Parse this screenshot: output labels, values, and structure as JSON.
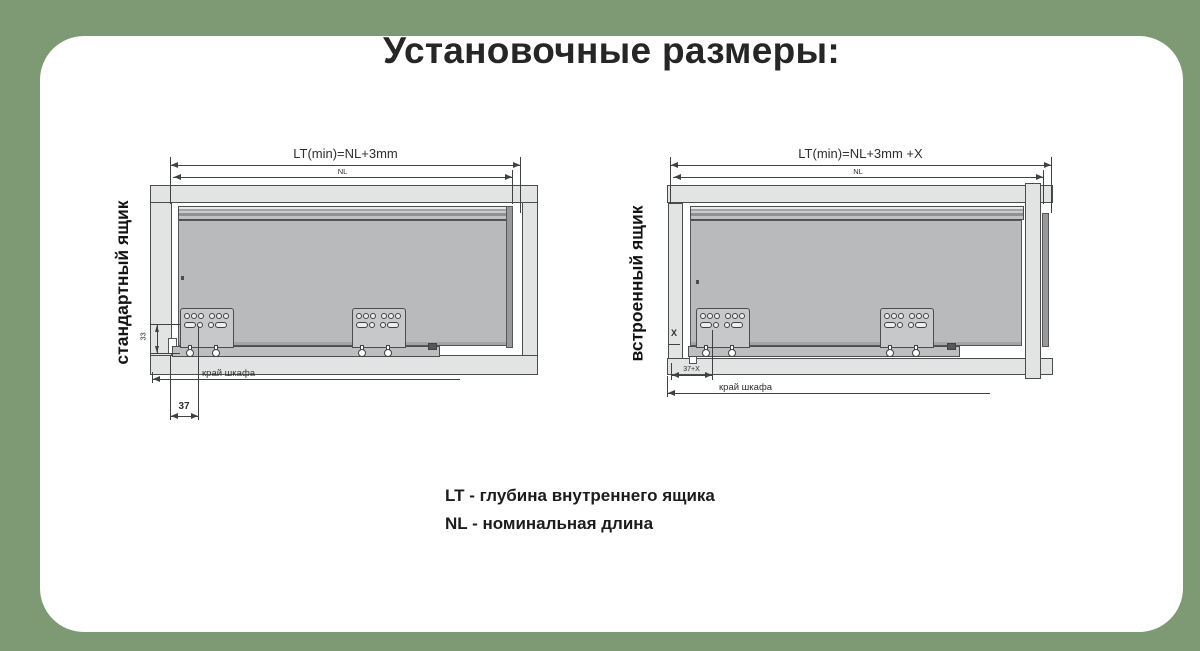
{
  "title": "Установочные размеры:",
  "colors": {
    "background": "#7d9a74",
    "card": "#ffffff",
    "drawing_line": "#3f4142",
    "cabinet_fill": "#e2e3e3",
    "drawer_fill": "#b8babc"
  },
  "diagrams": {
    "standard": {
      "side_label": "стандартный ящик",
      "dim_lt": "LT(min)=NL+3mm",
      "dim_nl": "NL",
      "dim_height": "33",
      "dim_offset": "37",
      "edge_label": "край шкафа"
    },
    "built_in": {
      "side_label": "встроенный ящик",
      "dim_lt": "LT(min)=NL+3mm +X",
      "dim_nl": "NL",
      "dim_x": "X",
      "dim_offset": "37+X",
      "edge_label": "край шкафа"
    }
  },
  "legend": {
    "lt": "LT -  глубина внутреннего ящика",
    "nl": "NL - номинальная длина"
  }
}
